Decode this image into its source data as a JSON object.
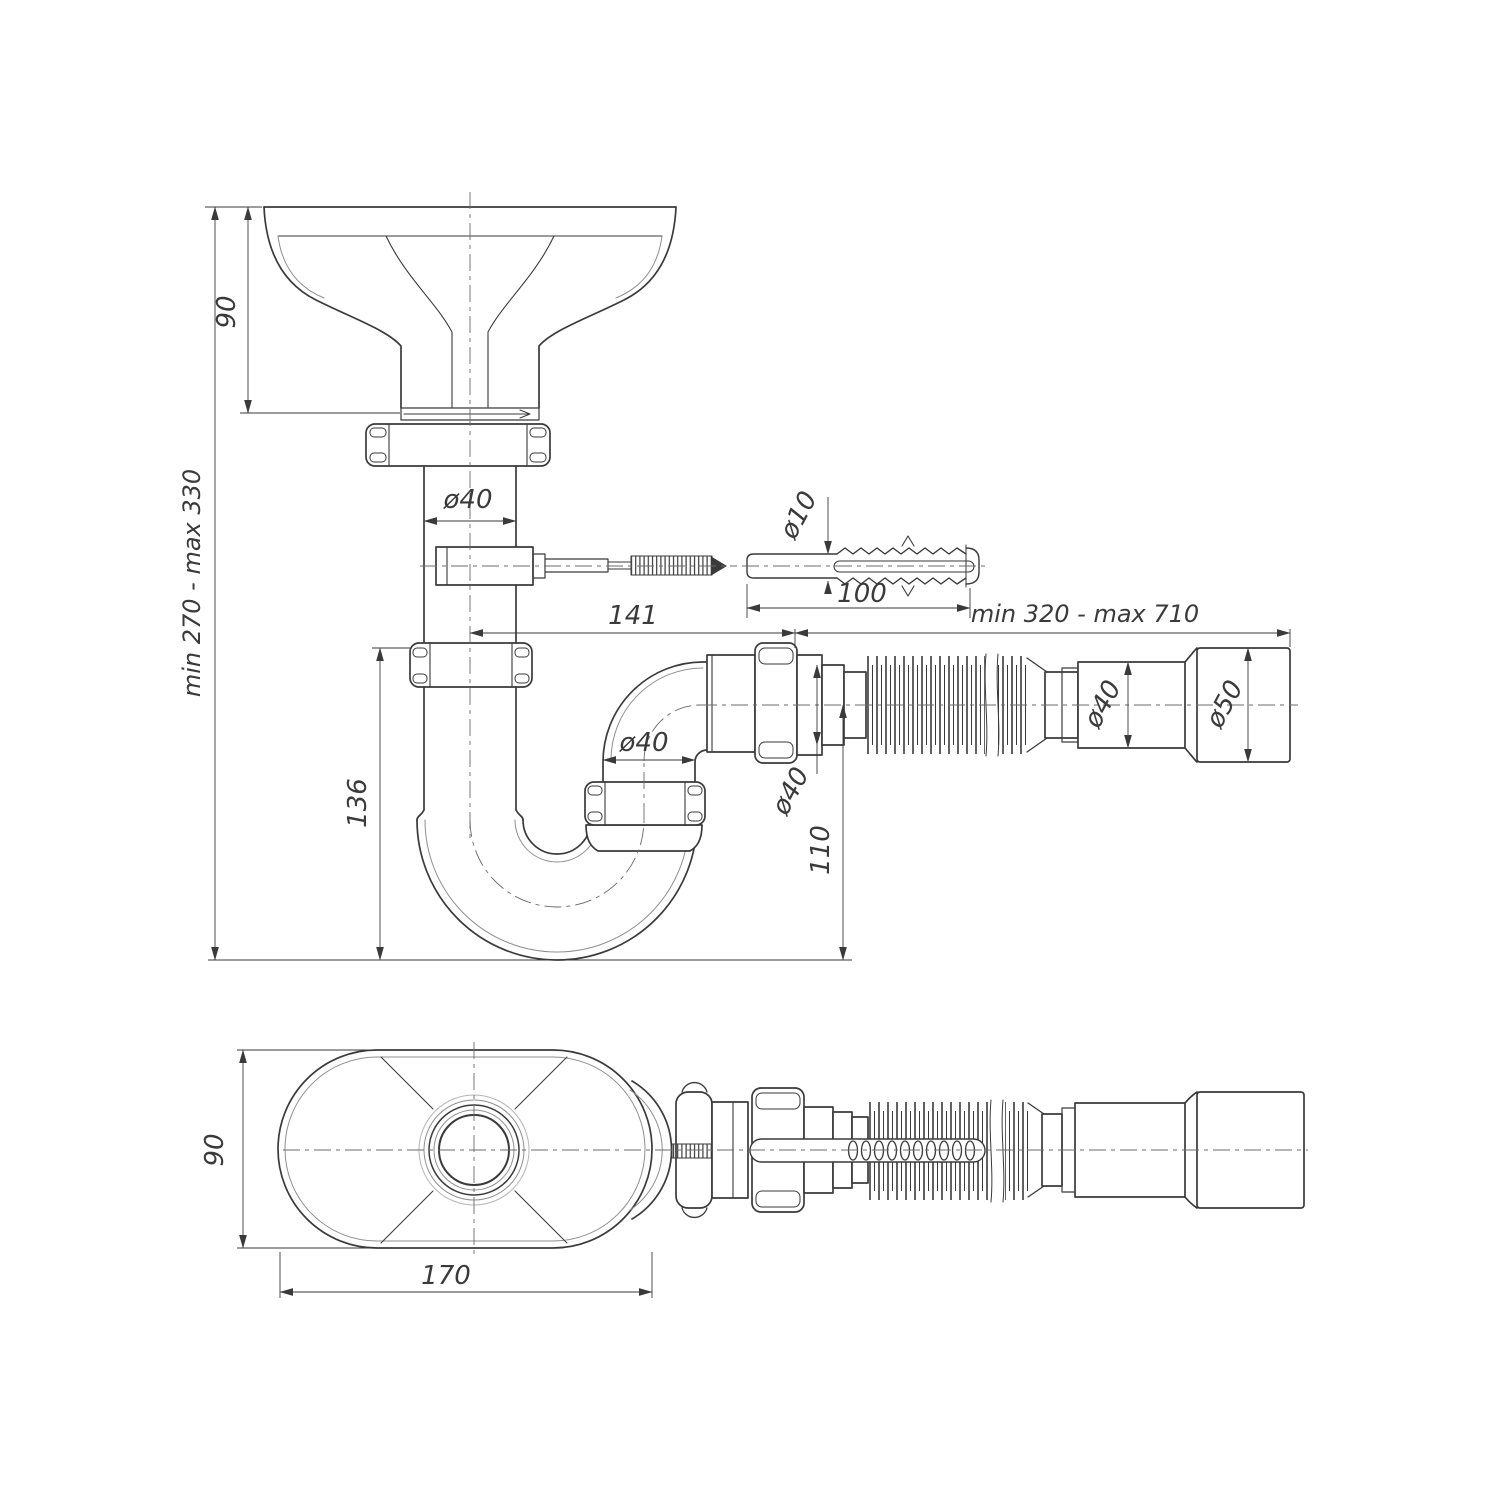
{
  "drawing": {
    "kind": "technical-drawing",
    "subject": "bottle trap siphon with flexible outlet pipe, mounting screw and wall plug",
    "views": [
      "front-elevation",
      "bottom-plan"
    ]
  },
  "dims": {
    "funnel_height": "90",
    "overall_height": "min 270 - max 330",
    "trap_height": "136",
    "pipe_diameter": "ø40",
    "screw_plug_diameter": "ø10",
    "plug_length": "100",
    "offset_length": "141",
    "flex_length_range": "min 320 - max 710",
    "elbow_diameter": "ø40",
    "outlet_spigot_diameter": "ø40",
    "outlet_axis_height": "110",
    "flex_pipe_diameter": "ø40",
    "end_cup_diameter": "ø50",
    "body_width": "90",
    "body_length": "170"
  },
  "colors": {
    "line": "#3a3a3a",
    "thin_line": "#8f8f8f",
    "background": "#ffffff"
  }
}
